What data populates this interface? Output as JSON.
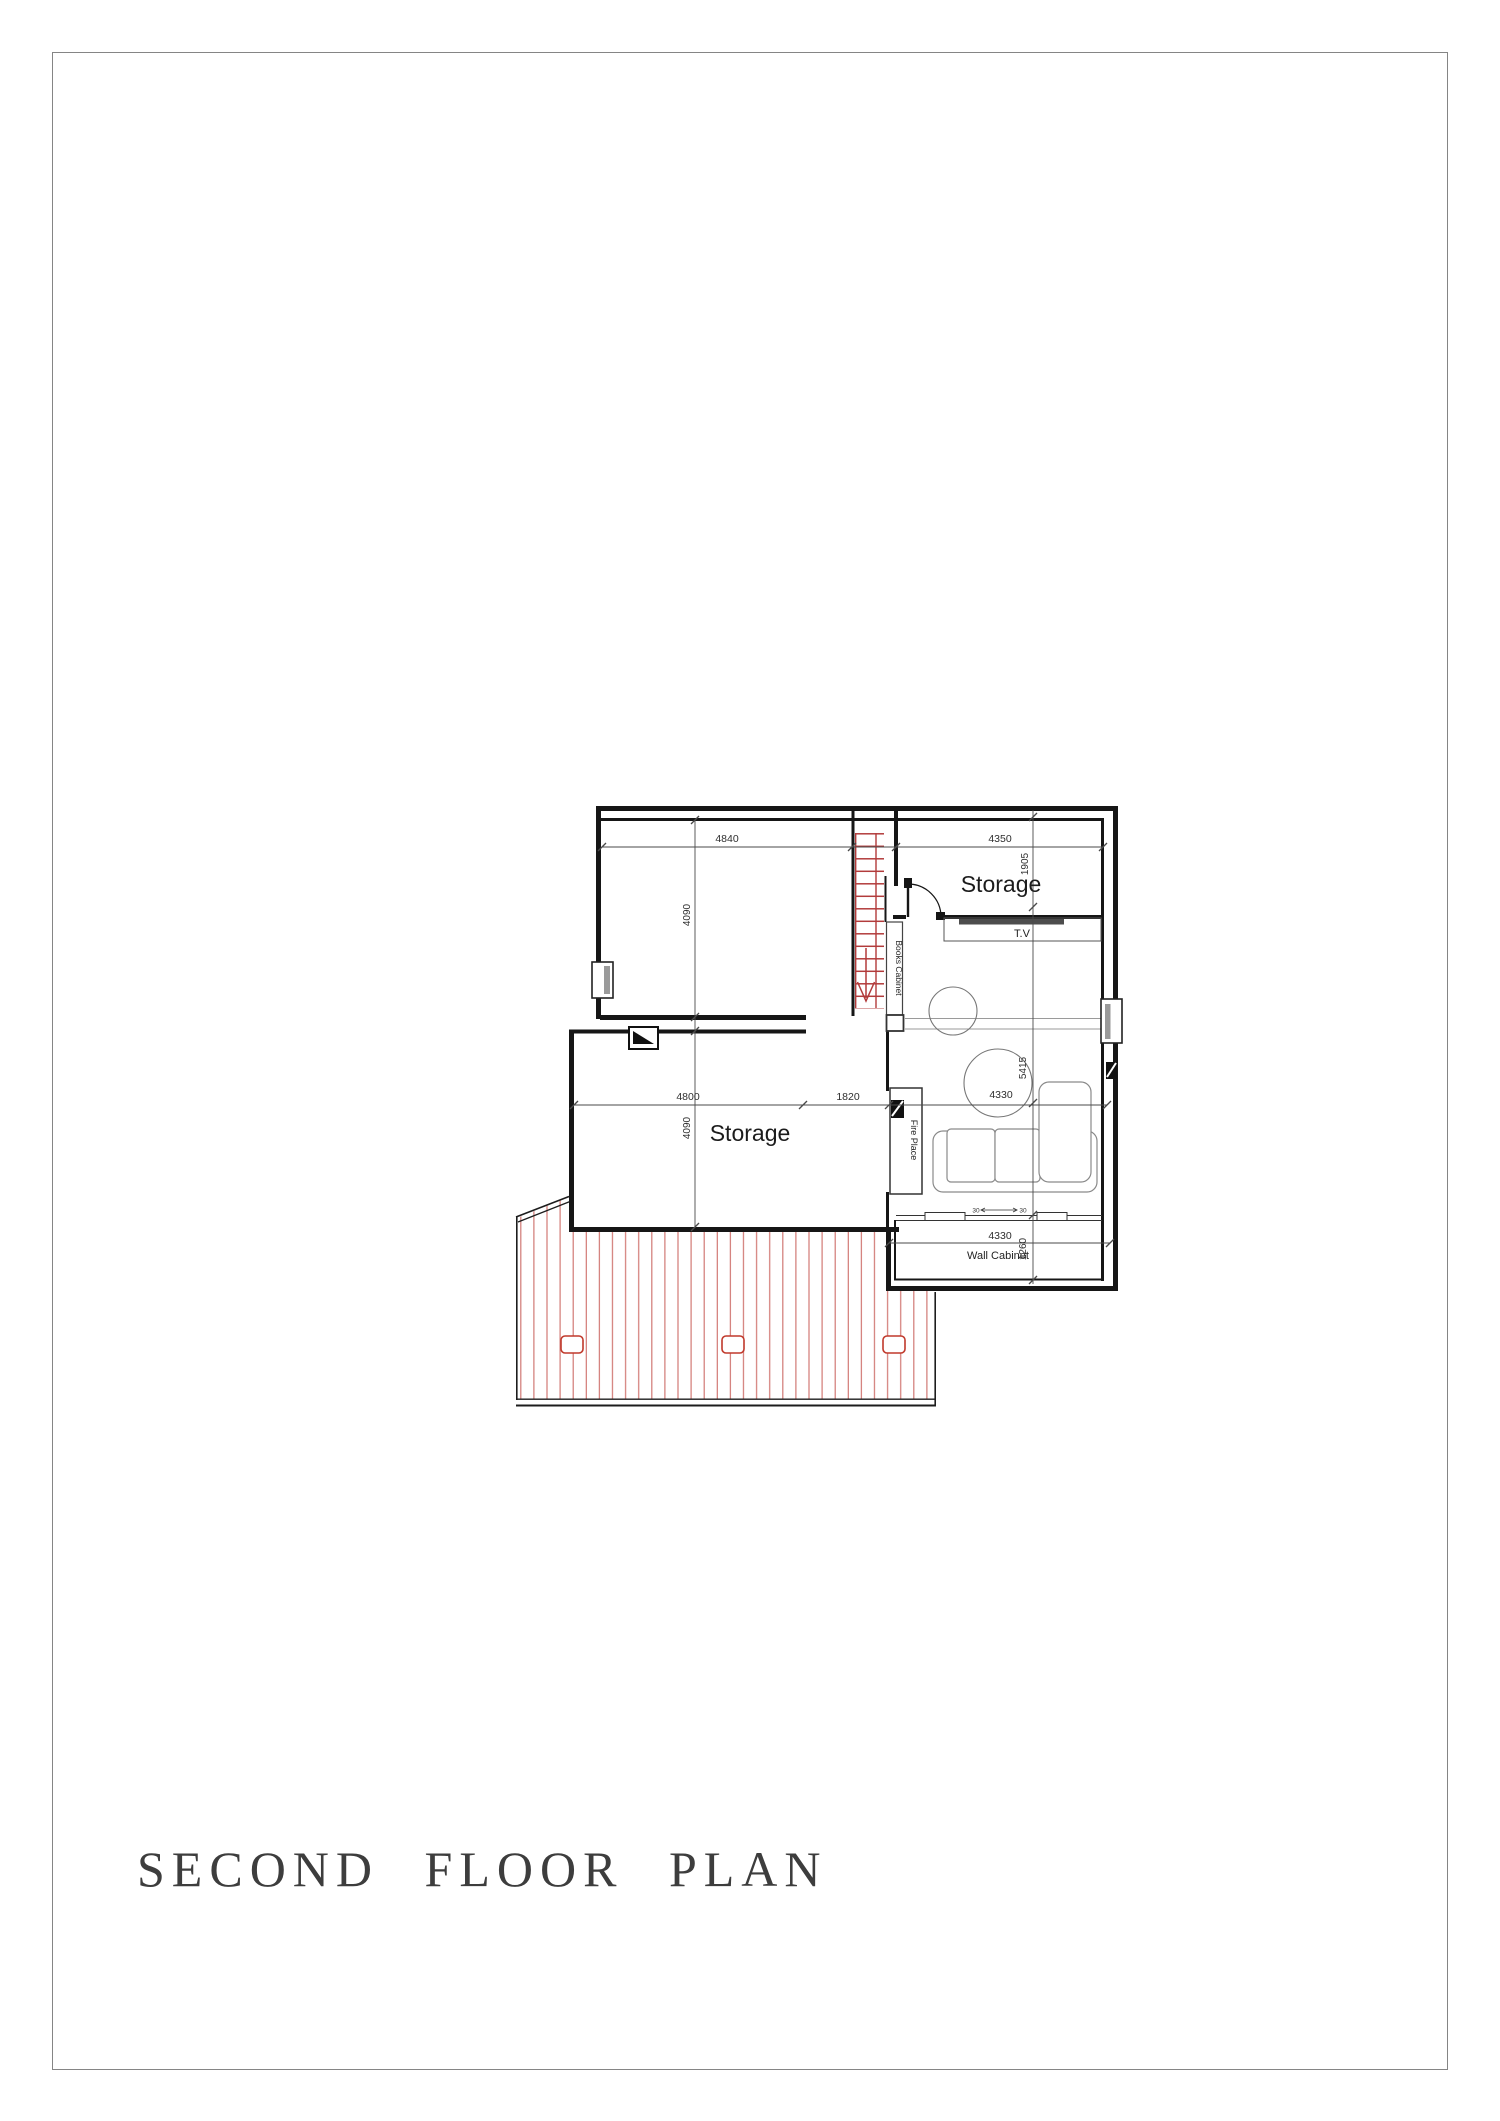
{
  "page": {
    "title": "SECOND FLOOR PLAN"
  },
  "plan": {
    "rooms": {
      "storage_upper": "Storage",
      "storage_lower": "Storage"
    },
    "fixtures": {
      "books_cabinet": "Books Cabinet",
      "tv": "T.V",
      "fire_place": "Fire Place",
      "wall_cabinet": "Wall Cabinet"
    },
    "dimensions": {
      "top_left_width": "4840",
      "top_right_width": "4350",
      "storage_upper_depth": "1905",
      "upper_room_height": "4090",
      "lower_room_height": "4090",
      "lower_room_width": "4800",
      "passage_width": "1820",
      "living_width": "4330",
      "living_height": "5415",
      "cabinet_width": "4330",
      "cabinet_depth": "1260",
      "sill_left": "30",
      "sill_right": "30"
    },
    "colors": {
      "wall": "#161616",
      "stair_red": "#b23b3b",
      "deck_hatch": "#c9605c",
      "light_red": "#c0392b",
      "dim_gray": "#4a4a4a",
      "title_gray": "#3d3d3d"
    }
  }
}
